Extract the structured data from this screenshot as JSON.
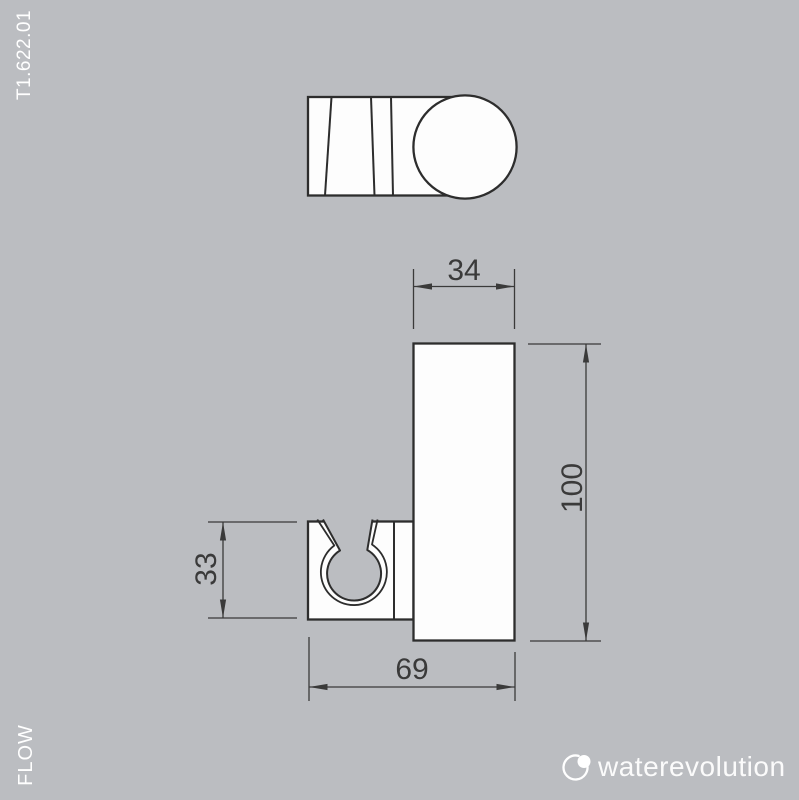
{
  "colors": {
    "background": "#bbbdc1",
    "line": "#2d2d2d",
    "dimension": "#3a3a3a",
    "fill": "#fdfdfd",
    "label": "#ffffff"
  },
  "labels": {
    "product_code": "T1.622.01",
    "series": "FLOW"
  },
  "dimensions": {
    "body_width": "34",
    "body_height": "100",
    "clip_height": "33",
    "total_depth": "69"
  },
  "brand": {
    "wordmark": "waterevolution",
    "icon": "droplet-ring-icon"
  }
}
